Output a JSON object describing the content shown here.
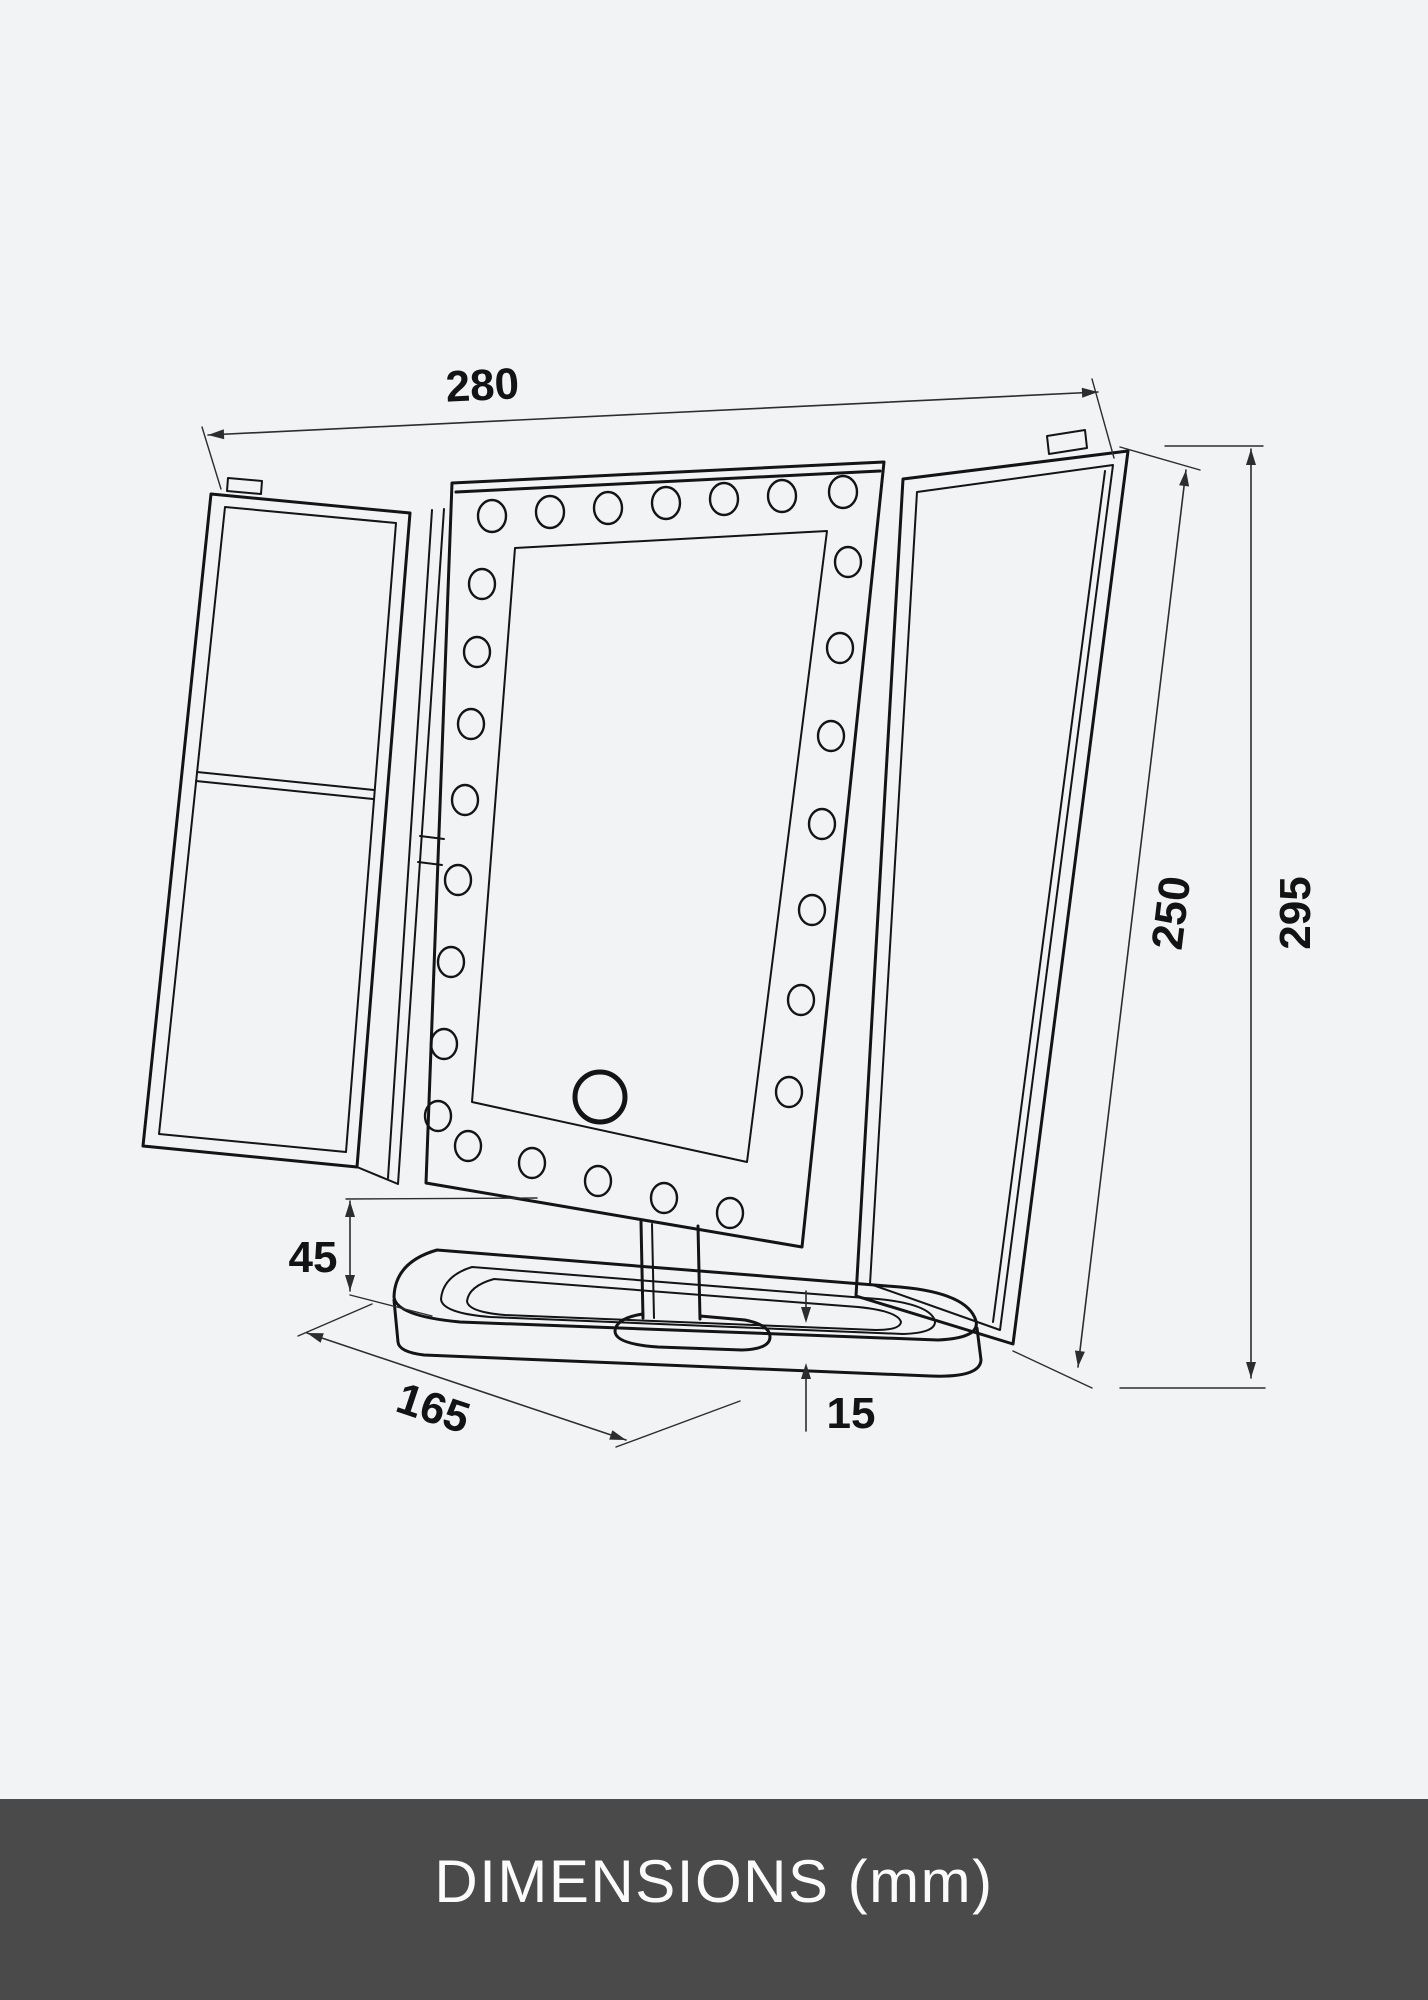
{
  "page": {
    "background_color": "#f2f3f5"
  },
  "footer": {
    "label": "DIMENSIONS (mm)",
    "background_color": "#4a4a4b",
    "text_color": "#fbfbfb"
  },
  "diagram": {
    "subject": "trifold-led-makeup-mirror-line-drawing",
    "unit": "mm",
    "line_color": "#141414",
    "dimension_color": "#2d2d2d",
    "dimensions": {
      "top_width": {
        "value": "280"
      },
      "panel_height": {
        "value": "250"
      },
      "overall_height": {
        "value": "295"
      },
      "stand_height": {
        "value": "45"
      },
      "base_depth": {
        "value": "165"
      },
      "base_thickness": {
        "value": "15"
      }
    }
  }
}
